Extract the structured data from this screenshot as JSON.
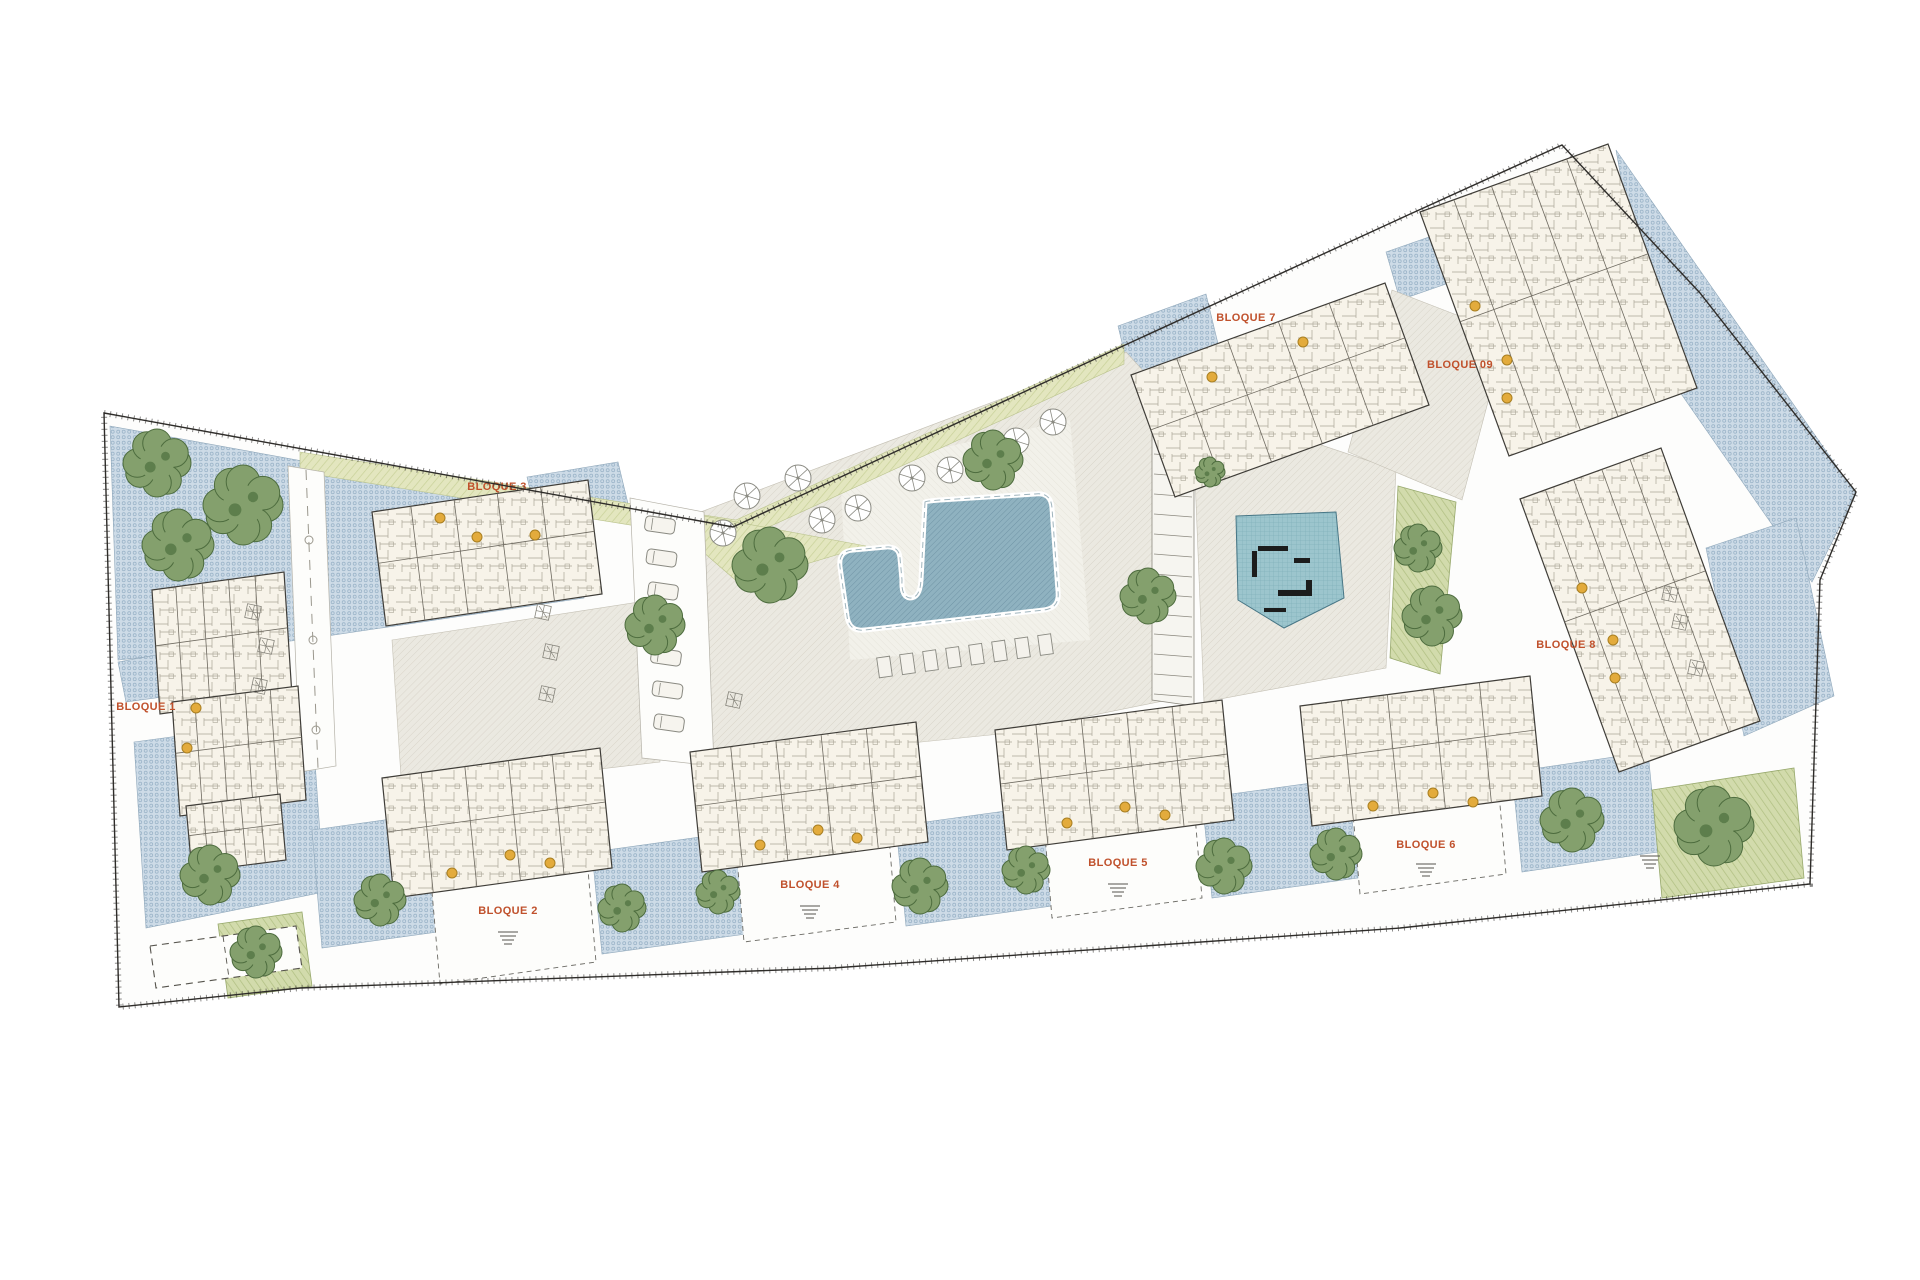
{
  "page": {
    "background": "#ffffff",
    "type": "architectural-site-plan"
  },
  "palette": {
    "label_orange": "#c0512c",
    "terrace_blue": "#cddbe7",
    "terrace_dot": "#9cb5c9",
    "plaza_gray": "#ebe9e1",
    "plaza_hatch": "#d9d5ca",
    "deck": "#f2f1ea",
    "lawn": "#e3e6bf",
    "lawn_stripe": "#c8d198",
    "garden": "#d2dbac",
    "garden_stripe": "#b1c083",
    "pool_fill": "#8fb2c0",
    "pool_hatch": "#7094a6",
    "pool_border": "#ffffff",
    "play_fill": "#9cc5cd",
    "play_grid": "#7cadb8",
    "equipment": "#1c1c1c",
    "building_fill": "#f7f3e9",
    "building_line": "#3f3d38",
    "wall_line": "#6e6a60",
    "tree_fill": "#84a06d",
    "tree_stroke": "#4d6c3e",
    "tree_speckle": "#5d7e4c",
    "boundary": "#2e2c29",
    "entrance_dot": "#e3ab3c",
    "entrance_dot_stroke": "#a87f22",
    "furniture": "#8a8a82"
  },
  "labels": [
    {
      "text": "BLOQUE 1",
      "x": 146,
      "y": 710
    },
    {
      "text": "BLOQUE 2",
      "x": 508,
      "y": 914
    },
    {
      "text": "BLOQUE 3",
      "x": 497,
      "y": 490
    },
    {
      "text": "BLOQUE 4",
      "x": 810,
      "y": 888
    },
    {
      "text": "BLOQUE 5",
      "x": 1118,
      "y": 866
    },
    {
      "text": "BLOQUE 6",
      "x": 1426,
      "y": 848
    },
    {
      "text": "BLOQUE 7",
      "x": 1246,
      "y": 321
    },
    {
      "text": "BLOQUE 8",
      "x": 1566,
      "y": 648
    },
    {
      "text": "BLOQUE 09",
      "x": 1460,
      "y": 368
    }
  ],
  "site": {
    "outline": [
      [
        104,
        413
      ],
      [
        733,
        527
      ],
      [
        1123,
        346
      ],
      [
        1408,
        215
      ],
      [
        1562,
        145
      ],
      [
        1700,
        293
      ],
      [
        1856,
        492
      ],
      [
        1820,
        580
      ],
      [
        1810,
        884
      ],
      [
        1400,
        928
      ],
      [
        833,
        968
      ],
      [
        300,
        988
      ],
      [
        119,
        1007
      ]
    ]
  },
  "zones": {
    "blue": [
      [
        [
          110,
          426
        ],
        [
          572,
          510
        ],
        [
          584,
          598
        ],
        [
          300,
          640
        ],
        [
          118,
          660
        ]
      ],
      [
        [
          527,
          477
        ],
        [
          618,
          462
        ],
        [
          630,
          512
        ],
        [
          539,
          527
        ]
      ],
      [
        [
          118,
          662
        ],
        [
          162,
          654
        ],
        [
          170,
          696
        ],
        [
          126,
          702
        ]
      ],
      [
        [
          134,
          742
        ],
        [
          312,
          718
        ],
        [
          324,
          892
        ],
        [
          146,
          928
        ]
      ],
      [
        [
          312,
          830
        ],
        [
          442,
          812
        ],
        [
          452,
          930
        ],
        [
          322,
          948
        ]
      ],
      [
        [
          592,
          852
        ],
        [
          736,
          832
        ],
        [
          746,
          934
        ],
        [
          602,
          954
        ]
      ],
      [
        [
          896,
          826
        ],
        [
          1042,
          806
        ],
        [
          1052,
          906
        ],
        [
          906,
          926
        ]
      ],
      [
        [
          1202,
          798
        ],
        [
          1348,
          778
        ],
        [
          1358,
          878
        ],
        [
          1212,
          898
        ]
      ],
      [
        [
          1512,
          772
        ],
        [
          1648,
          752
        ],
        [
          1658,
          852
        ],
        [
          1522,
          872
        ]
      ],
      [
        [
          1616,
          150
        ],
        [
          1856,
          494
        ],
        [
          1812,
          582
        ],
        [
          1652,
          352
        ]
      ],
      [
        [
          1118,
          326
        ],
        [
          1206,
          294
        ],
        [
          1220,
          352
        ],
        [
          1132,
          384
        ]
      ],
      [
        [
          1386,
          252
        ],
        [
          1472,
          222
        ],
        [
          1486,
          270
        ],
        [
          1400,
          300
        ]
      ],
      [
        [
          1706,
          548
        ],
        [
          1796,
          518
        ],
        [
          1834,
          696
        ],
        [
          1744,
          736
        ]
      ]
    ],
    "gray": [
      [
        [
          658,
          528
        ],
        [
          1126,
          352
        ],
        [
          1168,
          398
        ],
        [
          1168,
          700
        ],
        [
          1000,
          734
        ],
        [
          704,
          764
        ],
        [
          664,
          706
        ]
      ],
      [
        [
          392,
          640
        ],
        [
          652,
          600
        ],
        [
          660,
          762
        ],
        [
          402,
          792
        ]
      ],
      [
        [
          1192,
          402
        ],
        [
          1396,
          470
        ],
        [
          1386,
          668
        ],
        [
          1204,
          702
        ]
      ],
      [
        [
          1392,
          290
        ],
        [
          1506,
          334
        ],
        [
          1462,
          500
        ],
        [
          1348,
          452
        ]
      ]
    ],
    "deck": [
      [
        [
          840,
          470
        ],
        [
          1070,
          420
        ],
        [
          1090,
          640
        ],
        [
          850,
          660
        ]
      ]
    ],
    "lawn": [
      [
        [
          300,
          452
        ],
        [
          736,
          520
        ],
        [
          1124,
          344
        ],
        [
          1124,
          364
        ],
        [
          736,
          542
        ],
        [
          300,
          472
        ]
      ],
      [
        [
          650,
          506
        ],
        [
          866,
          546
        ],
        [
          740,
          584
        ]
      ]
    ],
    "green": [
      [
        [
          218,
          924
        ],
        [
          302,
          912
        ],
        [
          312,
          986
        ],
        [
          228,
          998
        ]
      ],
      [
        [
          1652,
          790
        ],
        [
          1794,
          768
        ],
        [
          1804,
          878
        ],
        [
          1662,
          898
        ]
      ],
      [
        [
          1398,
          486
        ],
        [
          1456,
          502
        ],
        [
          1440,
          674
        ],
        [
          1390,
          658
        ]
      ]
    ],
    "paths": [
      {
        "poly": [
          [
            288,
            466
          ],
          [
            324,
            472
          ],
          [
            336,
            766
          ],
          [
            300,
            772
          ]
        ],
        "center": [
          [
            306,
            470
          ],
          [
            318,
            768
          ]
        ]
      },
      {
        "poly": [
          [
            630,
            498
          ],
          [
            704,
            512
          ],
          [
            714,
            766
          ],
          [
            642,
            758
          ]
        ],
        "center": null
      }
    ],
    "portals": [
      [
        [
          432,
          892
        ],
        [
          588,
          870
        ],
        [
          596,
          962
        ],
        [
          440,
          984
        ]
      ],
      [
        [
          736,
          846
        ],
        [
          888,
          826
        ],
        [
          896,
          922
        ],
        [
          744,
          942
        ]
      ],
      [
        [
          1044,
          824
        ],
        [
          1194,
          804
        ],
        [
          1202,
          898
        ],
        [
          1052,
          918
        ]
      ],
      [
        [
          1352,
          802
        ],
        [
          1498,
          782
        ],
        [
          1506,
          874
        ],
        [
          1360,
          894
        ]
      ]
    ],
    "ramp": {
      "poly": [
        [
          1152,
          398
        ],
        [
          1194,
          412
        ],
        [
          1194,
          706
        ],
        [
          1152,
          700
        ]
      ],
      "rung_from": 414,
      "rung_to": 698,
      "rung_step": 20
    }
  },
  "buildings": [
    {
      "id": "bloque-1a",
      "pts": [
        [
          152,
          590
        ],
        [
          284,
          572
        ],
        [
          292,
          696
        ],
        [
          160,
          714
        ]
      ]
    },
    {
      "id": "bloque-1b",
      "pts": [
        [
          172,
          702
        ],
        [
          298,
          686
        ],
        [
          306,
          800
        ],
        [
          180,
          816
        ]
      ]
    },
    {
      "id": "bloque-1c",
      "pts": [
        [
          186,
          806
        ],
        [
          280,
          794
        ],
        [
          286,
          860
        ],
        [
          192,
          872
        ]
      ]
    },
    {
      "id": "bloque-3",
      "pts": [
        [
          372,
          512
        ],
        [
          588,
          480
        ],
        [
          602,
          594
        ],
        [
          386,
          626
        ]
      ]
    },
    {
      "id": "bloque-2",
      "pts": [
        [
          382,
          778
        ],
        [
          600,
          748
        ],
        [
          612,
          868
        ],
        [
          394,
          898
        ]
      ]
    },
    {
      "id": "bloque-4",
      "pts": [
        [
          690,
          752
        ],
        [
          916,
          722
        ],
        [
          928,
          842
        ],
        [
          702,
          872
        ]
      ]
    },
    {
      "id": "bloque-5",
      "pts": [
        [
          995,
          730
        ],
        [
          1222,
          700
        ],
        [
          1234,
          820
        ],
        [
          1007,
          850
        ]
      ]
    },
    {
      "id": "bloque-6",
      "pts": [
        [
          1300,
          706
        ],
        [
          1530,
          676
        ],
        [
          1542,
          796
        ],
        [
          1312,
          826
        ]
      ]
    },
    {
      "id": "bloque-7",
      "pts": [
        [
          1131,
          375
        ],
        [
          1385,
          283
        ],
        [
          1429,
          405
        ],
        [
          1175,
          497
        ]
      ]
    },
    {
      "id": "bloque-9",
      "pts": [
        [
          1420,
          212
        ],
        [
          1608,
          144
        ],
        [
          1697,
          388
        ],
        [
          1509,
          456
        ]
      ]
    },
    {
      "id": "bloque-8",
      "pts": [
        [
          1520,
          499
        ],
        [
          1661,
          448
        ],
        [
          1760,
          721
        ],
        [
          1619,
          772
        ]
      ]
    }
  ],
  "pool": {
    "path": "M 925 502 L 921 580 Q 920 598 910 598 Q 901 597 902 580 L 900 558 Q 899 546 886 547 L 853 550 Q 838 551 840 567 L 847 616 Q 849 632 865 630 L 1044 610 Q 1060 608 1058 591 L 1052 508 Q 1051 492 1035 494 L 940 500 Q 926 501 925 502 Z"
  },
  "playground": {
    "poly": [
      [
        1236,
        516
      ],
      [
        1336,
        512
      ],
      [
        1344,
        598
      ],
      [
        1284,
        628
      ],
      [
        1238,
        600
      ]
    ],
    "equipment": [
      {
        "x": 1258,
        "y": 546,
        "w": 30,
        "h": 5
      },
      {
        "x": 1252,
        "y": 551,
        "w": 5,
        "h": 26
      },
      {
        "x": 1294,
        "y": 558,
        "w": 16,
        "h": 5
      },
      {
        "x": 1278,
        "y": 590,
        "w": 30,
        "h": 6
      },
      {
        "x": 1306,
        "y": 580,
        "w": 6,
        "h": 16
      },
      {
        "x": 1264,
        "y": 608,
        "w": 22,
        "h": 4
      }
    ]
  },
  "trees": [
    [
      157,
      463,
      34
    ],
    [
      243,
      505,
      40
    ],
    [
      178,
      545,
      36
    ],
    [
      210,
      875,
      30
    ],
    [
      380,
      900,
      26
    ],
    [
      622,
      908,
      24
    ],
    [
      718,
      892,
      22
    ],
    [
      920,
      886,
      28
    ],
    [
      1026,
      870,
      24
    ],
    [
      1224,
      866,
      28
    ],
    [
      1336,
      854,
      26
    ],
    [
      1572,
      820,
      32
    ],
    [
      256,
      952,
      26
    ],
    [
      1714,
      826,
      40
    ],
    [
      1418,
      548,
      24
    ],
    [
      1432,
      616,
      30
    ],
    [
      655,
      625,
      30
    ],
    [
      770,
      565,
      38
    ],
    [
      993,
      460,
      30
    ],
    [
      1148,
      596,
      28
    ],
    [
      1210,
      472,
      15
    ]
  ],
  "parasols": [
    [
      723,
      533
    ],
    [
      747,
      496
    ],
    [
      798,
      478
    ],
    [
      822,
      520
    ],
    [
      858,
      508
    ],
    [
      912,
      478
    ],
    [
      950,
      470
    ],
    [
      1016,
      441
    ],
    [
      1053,
      422
    ]
  ],
  "loungers": {
    "x0": 878,
    "y0": 657,
    "dx": 23,
    "dy": -3.2,
    "count": 8,
    "w": 13,
    "h": 20,
    "rot": -8
  },
  "cars": {
    "x0": 660,
    "y0": 525,
    "dx": 1.5,
    "dy": 33,
    "count": 7,
    "w": 30,
    "h": 15,
    "rot": 8
  },
  "parking_stall": {
    "poly": [
      [
        150,
        946
      ],
      [
        296,
        926
      ],
      [
        302,
        968
      ],
      [
        156,
        988
      ]
    ]
  },
  "entrance_dots": [
    [
      196,
      708
    ],
    [
      187,
      748
    ],
    [
      440,
      518
    ],
    [
      477,
      537
    ],
    [
      535,
      535
    ],
    [
      510,
      855
    ],
    [
      550,
      863
    ],
    [
      452,
      873
    ],
    [
      818,
      830
    ],
    [
      857,
      838
    ],
    [
      760,
      845
    ],
    [
      1125,
      807
    ],
    [
      1165,
      815
    ],
    [
      1067,
      823
    ],
    [
      1433,
      793
    ],
    [
      1473,
      802
    ],
    [
      1373,
      806
    ],
    [
      1303,
      342
    ],
    [
      1212,
      377
    ],
    [
      1475,
      306
    ],
    [
      1507,
      360
    ],
    [
      1507,
      398
    ],
    [
      1582,
      588
    ],
    [
      1613,
      640
    ],
    [
      1615,
      678
    ]
  ],
  "shrubs": [
    [
      253,
      612
    ],
    [
      266,
      646
    ],
    [
      259,
      686
    ],
    [
      543,
      612
    ],
    [
      551,
      652
    ],
    [
      547,
      694
    ],
    [
      1670,
      594
    ],
    [
      1680,
      622
    ],
    [
      1696,
      668
    ],
    [
      734,
      700
    ]
  ],
  "stairs": [
    [
      508,
      938
    ],
    [
      810,
      912
    ],
    [
      1118,
      890
    ],
    [
      1426,
      870
    ],
    [
      1650,
      862
    ],
    [
      262,
      970
    ]
  ],
  "lamps": [
    [
      309,
      540
    ],
    [
      313,
      640
    ],
    [
      316,
      730
    ]
  ]
}
